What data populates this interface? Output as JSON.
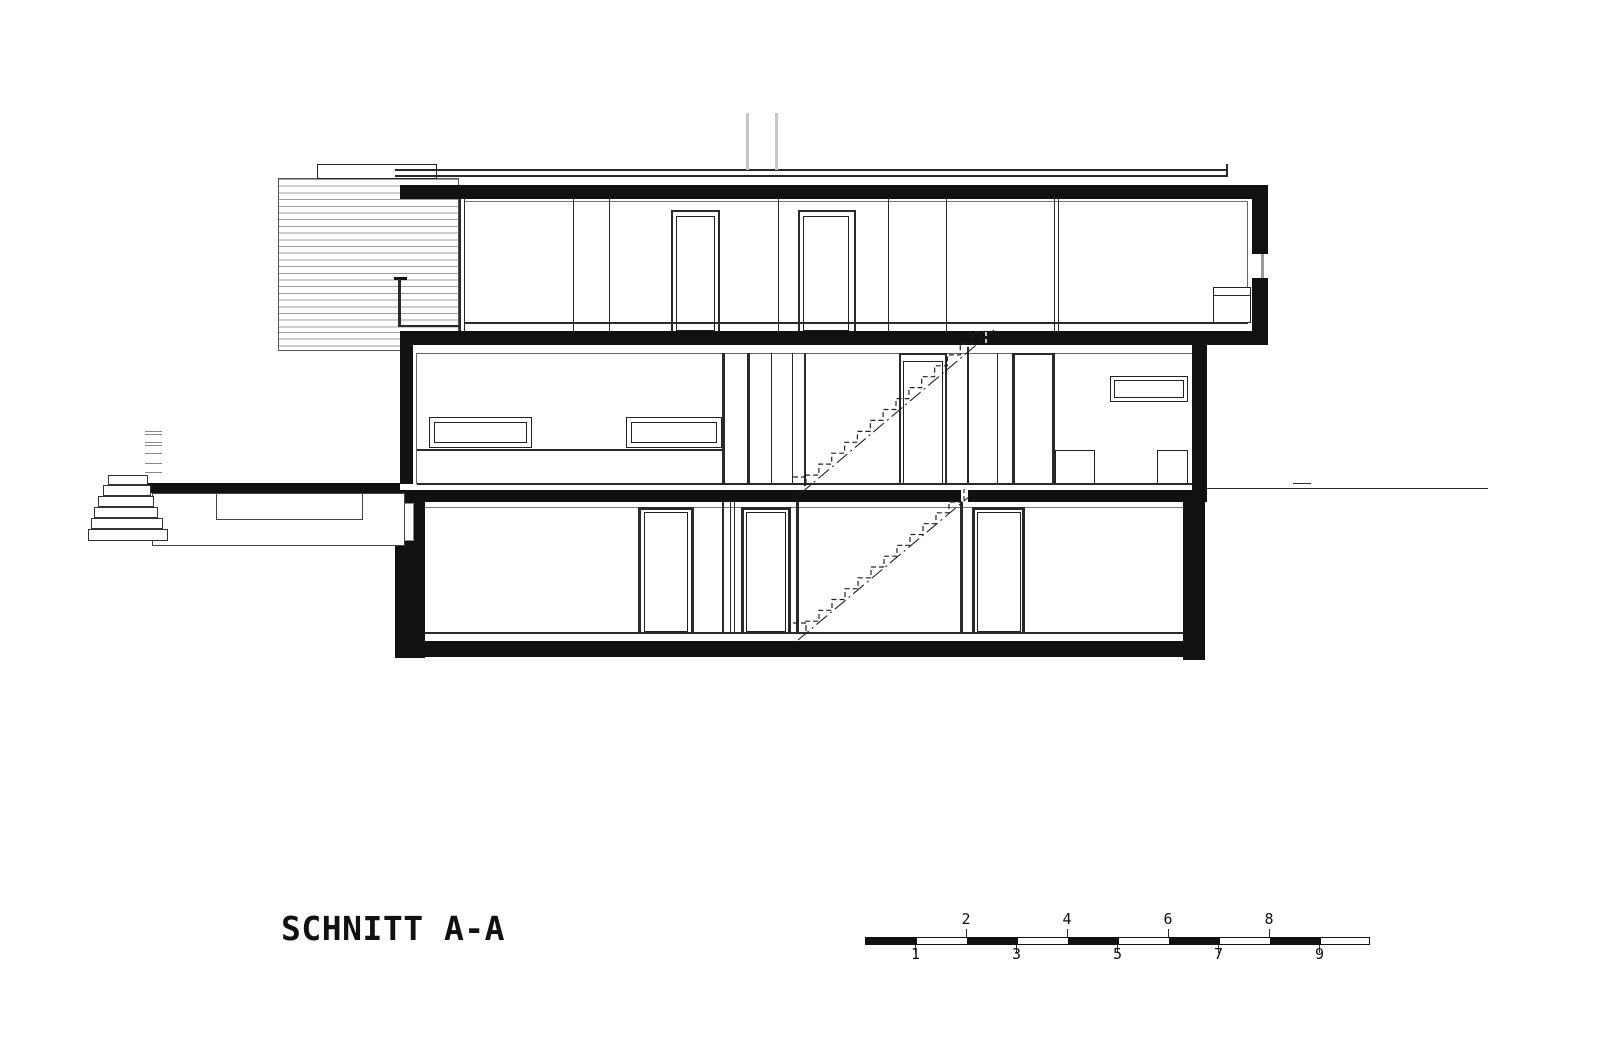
{
  "page": {
    "title": "SCHNITT A-A"
  },
  "scale_bar": {
    "top_labels": [
      "2",
      "4",
      "6",
      "8"
    ],
    "bottom_labels": [
      "1",
      "3",
      "5",
      "7",
      "9"
    ]
  },
  "colors": {
    "ink": "#111111",
    "background": "#ffffff",
    "hatch_line": "#9e9e9e",
    "pipe_gray": "#c6c6c6",
    "glass": "#999999"
  }
}
